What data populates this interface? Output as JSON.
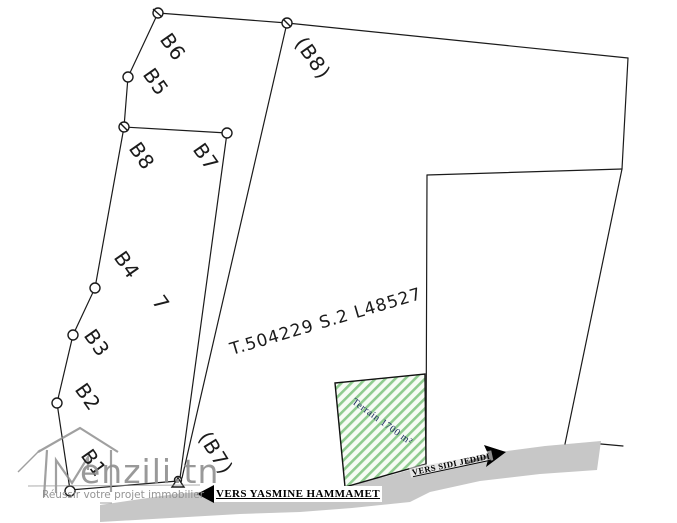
{
  "plan": {
    "reference": "T.504229 S.2 L48527",
    "lot_number": "7",
    "terrain": {
      "label": "Terrain 1700 m²"
    },
    "boundary_labels": {
      "b6": "B6",
      "b5": "B5",
      "b8": "B8",
      "b7": "B7",
      "b4": "B4",
      "b3": "B3",
      "b2": "B2",
      "b1": "B1",
      "b8_adjacent": "(B8)",
      "b7_adjacent": "(B7)"
    },
    "roads": {
      "to_yasmine": "VERS YASMINE HAMMAMET",
      "to_sidi": "VERS SIDI JEDIDI"
    }
  },
  "watermark": {
    "brand": "enzili.tn",
    "tagline": "Réussir votre projet immobilier"
  },
  "colors": {
    "line": "#1b1b1b",
    "road_gray": "#c7c7c7",
    "hatch_green": "#8fcb8f",
    "hatch_background": "#f7fcf5",
    "terrain_text": "#1e2b60",
    "watermark_gray": "#8f8f8f"
  }
}
